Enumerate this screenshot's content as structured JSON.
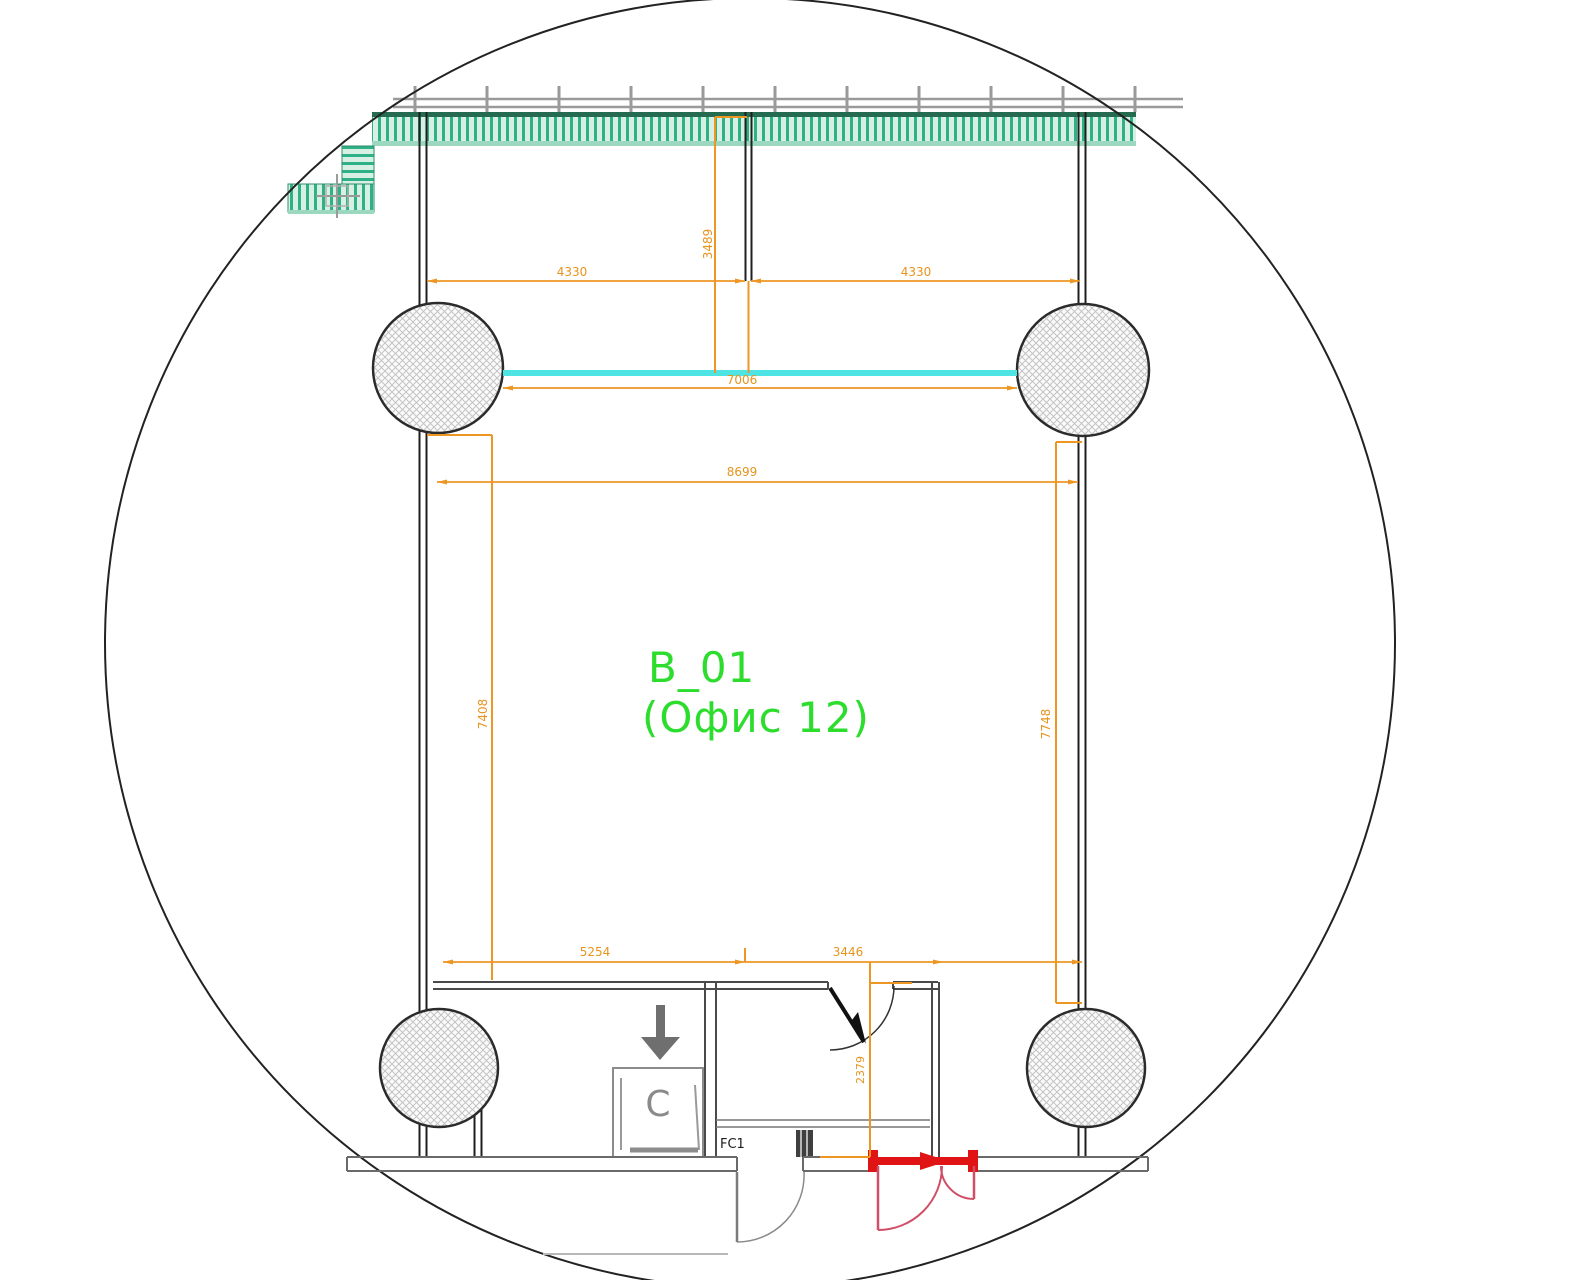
{
  "drawing": {
    "type": "architectural floor plan detail (circular viewport callout)",
    "room_label": {
      "line1": "B_01",
      "line2": "(Офис 12)",
      "color": "#2ddd2d"
    },
    "unit_labels": {
      "cabinet": "C",
      "floor_convector": "FC1"
    },
    "dimensions": {
      "top_left_4330": "4330",
      "top_right_4330": "4330",
      "vert_3489": "3489",
      "span_7006": "7006",
      "span_8699": "8699",
      "left_7408": "7408",
      "right_7748": "7748",
      "bottom_5254": "5254",
      "bottom_3446": "3446",
      "vert_2379": "2379"
    },
    "colors": {
      "dimension": "#e8931d",
      "dimension_line": "#ee9623",
      "glazing_cyan": "#4ee4e4",
      "wall_black": "#1f1f1f",
      "curtain_wall_green": "#2fb188",
      "curtain_wall_green_dark": "#256b50",
      "curtain_wall_green_light": "#9bd8bf",
      "door_red": "#e01414",
      "door_swing_pink": "#cf4f66",
      "secondary_gray": "#8c8c8c",
      "baseline_gray": "#6a6a6a"
    }
  }
}
